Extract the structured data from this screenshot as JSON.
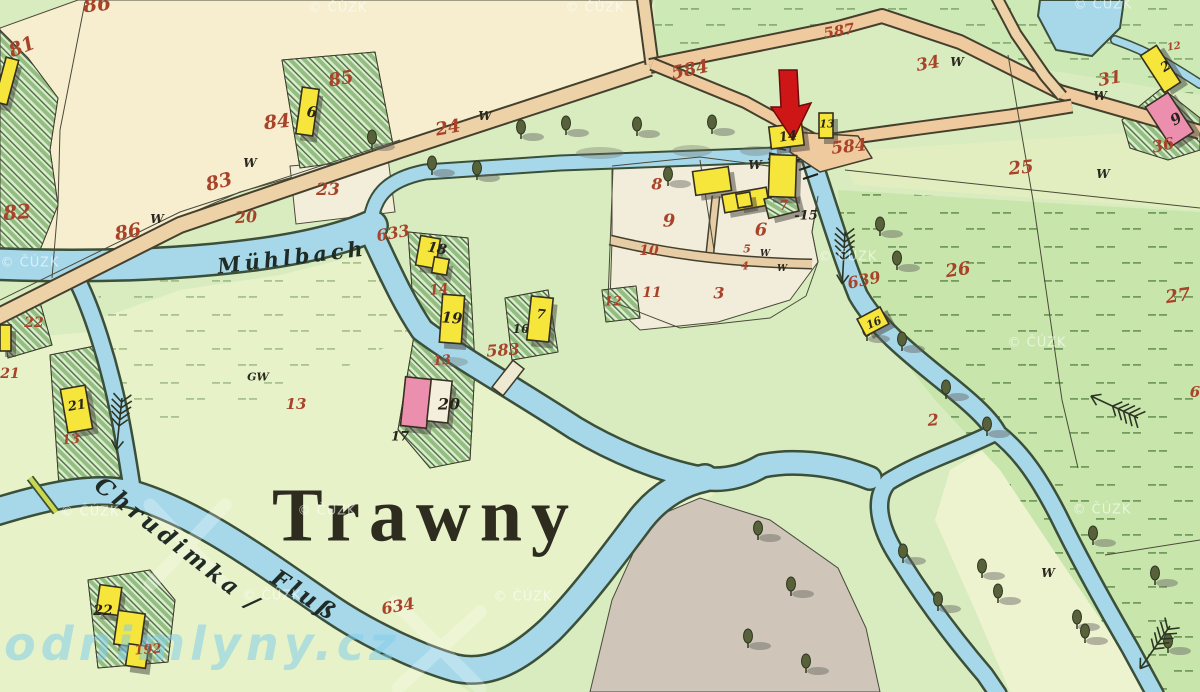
{
  "map": {
    "settlement": {
      "text": "Trawny",
      "x": 425,
      "y": 516,
      "size": 76
    },
    "water_labels": [
      {
        "text": "Mühlbach",
        "x": 292,
        "y": 257,
        "size": 21,
        "rot": -7
      },
      {
        "text": "Chrudimka /",
        "x": 178,
        "y": 545,
        "size": 23,
        "rot": 38
      },
      {
        "text": "Fluß",
        "x": 305,
        "y": 596,
        "size": 23,
        "rot": 33
      }
    ],
    "brand_watermark": {
      "text": "vodnimlyny.cz",
      "x": 185,
      "y": 644,
      "size": 46
    },
    "copyright_watermark_text": "© ČÚZK",
    "watermark_positions": [
      [
        338,
        8
      ],
      [
        595,
        8
      ],
      [
        1103,
        5
      ],
      [
        30,
        263
      ],
      [
        848,
        257
      ],
      [
        1037,
        343
      ],
      [
        1102,
        510
      ],
      [
        90,
        512
      ],
      [
        272,
        596
      ],
      [
        523,
        597
      ],
      [
        327,
        511
      ]
    ],
    "parcel_numbers_red": [
      [
        "86",
        97,
        4,
        20,
        -6
      ],
      [
        "81",
        22,
        47,
        19,
        -22
      ],
      [
        "82",
        17,
        212,
        20,
        -5
      ],
      [
        "86",
        128,
        232,
        19,
        -10
      ],
      [
        "83",
        219,
        182,
        19,
        -14
      ],
      [
        "84",
        277,
        122,
        19,
        -6
      ],
      [
        "85",
        341,
        79,
        18,
        -10
      ],
      [
        "24",
        448,
        128,
        18,
        -10
      ],
      [
        "23",
        328,
        190,
        17,
        0
      ],
      [
        "20",
        246,
        217,
        16,
        -4
      ],
      [
        "633",
        393,
        233,
        16,
        -10
      ],
      [
        "584",
        690,
        70,
        18,
        -12
      ],
      [
        "587",
        839,
        31,
        15,
        -10
      ],
      [
        "584",
        849,
        147,
        17,
        -6
      ],
      [
        "34",
        928,
        64,
        17,
        -10
      ],
      [
        "31",
        1110,
        79,
        17,
        -10
      ],
      [
        "25",
        1021,
        168,
        18,
        -6
      ],
      [
        "12",
        1174,
        47,
        10,
        -10
      ],
      [
        "36",
        1163,
        145,
        16,
        -12
      ],
      [
        "26",
        958,
        270,
        18,
        -8
      ],
      [
        "27",
        1178,
        296,
        18,
        -8
      ],
      [
        "2",
        933,
        420,
        16,
        -4
      ],
      [
        "639",
        864,
        280,
        16,
        -12
      ],
      [
        "8",
        657,
        184,
        16,
        0
      ],
      [
        "9",
        669,
        221,
        18,
        0
      ],
      [
        "6",
        761,
        230,
        18,
        0
      ],
      [
        "10",
        649,
        251,
        14,
        0
      ],
      [
        "5",
        747,
        249,
        11,
        0
      ],
      [
        "4",
        745,
        266,
        11,
        0
      ],
      [
        "11",
        652,
        293,
        14,
        0
      ],
      [
        "3",
        719,
        293,
        16,
        0
      ],
      [
        "12",
        613,
        302,
        13,
        0
      ],
      [
        "7",
        784,
        206,
        13,
        -5
      ],
      [
        "583",
        503,
        350,
        16,
        -4
      ],
      [
        "13",
        296,
        404,
        15,
        0
      ],
      [
        "14",
        439,
        290,
        14,
        -6
      ],
      [
        "13",
        442,
        361,
        13,
        -6
      ],
      [
        "22",
        34,
        323,
        14,
        0
      ],
      [
        "21",
        10,
        374,
        14,
        0
      ],
      [
        "13",
        71,
        440,
        13,
        -6
      ],
      [
        "634",
        398,
        606,
        16,
        -10
      ],
      [
        "192",
        148,
        650,
        13,
        -4
      ],
      [
        "6",
        1195,
        392,
        15,
        0
      ]
    ],
    "house_numbers_black": [
      [
        "6",
        312,
        112,
        15,
        8
      ],
      [
        "14",
        788,
        137,
        13,
        -8
      ],
      [
        "13",
        827,
        124,
        11,
        0
      ],
      [
        "18",
        437,
        249,
        14,
        10
      ],
      [
        "19",
        452,
        318,
        15,
        4
      ],
      [
        "16",
        521,
        329,
        12,
        0
      ],
      [
        "7",
        541,
        315,
        13,
        6
      ],
      [
        "-15",
        806,
        216,
        13,
        0
      ],
      [
        "20",
        449,
        404,
        16,
        0
      ],
      [
        "17",
        400,
        437,
        13,
        0
      ],
      [
        "21",
        77,
        406,
        13,
        -10
      ],
      [
        "22",
        103,
        611,
        14,
        0
      ],
      [
        "2",
        1166,
        67,
        13,
        -33
      ],
      [
        "9",
        1176,
        119,
        15,
        -33
      ],
      [
        "16",
        874,
        323,
        11,
        -24
      ]
    ],
    "w_marks": [
      [
        "W",
        250,
        163,
        12
      ],
      [
        "W",
        157,
        219,
        12
      ],
      [
        "W",
        485,
        116,
        12
      ],
      [
        "W",
        755,
        165,
        12
      ],
      [
        "W",
        765,
        254,
        9
      ],
      [
        "W",
        782,
        269,
        9
      ],
      [
        "W",
        957,
        62,
        12
      ],
      [
        "W",
        1100,
        96,
        12
      ],
      [
        "W",
        1103,
        174,
        12
      ],
      [
        "W",
        1048,
        573,
        12
      ],
      [
        "GW",
        258,
        377,
        11
      ]
    ],
    "annotation_arrow": {
      "color": "#cf1616",
      "x": 790,
      "y": 105,
      "points_to": "mill building 14"
    },
    "buildings": [
      [
        299,
        88,
        17,
        47,
        8,
        "y"
      ],
      [
        0,
        58,
        13,
        46,
        15,
        "y"
      ],
      [
        0,
        325,
        11,
        26,
        0,
        "y"
      ],
      [
        64,
        387,
        25,
        44,
        -10,
        "y"
      ],
      [
        418,
        237,
        20,
        30,
        10,
        "y"
      ],
      [
        433,
        258,
        15,
        16,
        10,
        "y"
      ],
      [
        441,
        295,
        22,
        48,
        4,
        "y"
      ],
      [
        529,
        297,
        22,
        44,
        6,
        "y"
      ],
      [
        403,
        378,
        26,
        49,
        6,
        "p"
      ],
      [
        429,
        380,
        21,
        42,
        6,
        "w"
      ],
      [
        694,
        169,
        36,
        24,
        -8,
        "y"
      ],
      [
        723,
        191,
        45,
        18,
        -10,
        "y"
      ],
      [
        737,
        193,
        14,
        14,
        -10,
        "y"
      ],
      [
        766,
        195,
        31,
        20,
        -14,
        "h"
      ],
      [
        770,
        125,
        33,
        22,
        -7,
        "y"
      ],
      [
        819,
        113,
        14,
        25,
        0,
        "y"
      ],
      [
        769,
        155,
        27,
        42,
        2,
        "y"
      ],
      [
        860,
        312,
        26,
        19,
        -28,
        "y"
      ],
      [
        1151,
        47,
        19,
        44,
        -33,
        "y"
      ],
      [
        1156,
        96,
        27,
        47,
        -33,
        "p"
      ],
      [
        98,
        586,
        22,
        28,
        8,
        "y"
      ],
      [
        116,
        612,
        27,
        34,
        8,
        "y"
      ],
      [
        127,
        645,
        20,
        22,
        8,
        "y"
      ]
    ],
    "trees": [
      [
        372,
        140
      ],
      [
        432,
        166
      ],
      [
        477,
        171
      ],
      [
        521,
        130
      ],
      [
        566,
        126
      ],
      [
        637,
        127
      ],
      [
        712,
        125
      ],
      [
        668,
        177
      ],
      [
        880,
        227
      ],
      [
        897,
        261
      ],
      [
        867,
        332
      ],
      [
        902,
        342
      ],
      [
        946,
        390
      ],
      [
        987,
        427
      ],
      [
        903,
        554
      ],
      [
        982,
        569
      ],
      [
        998,
        594
      ],
      [
        938,
        602
      ],
      [
        1077,
        620
      ],
      [
        1085,
        634
      ],
      [
        1155,
        576
      ],
      [
        1168,
        644
      ],
      [
        758,
        531
      ],
      [
        791,
        587
      ],
      [
        748,
        639
      ],
      [
        806,
        664
      ],
      [
        1093,
        536
      ]
    ],
    "colors": {
      "meadow_green": "#c8e6ab",
      "pale_green": "#e7f2c8",
      "field_cream": "#f6eecf",
      "water_blue": "#a6d8ea",
      "road_tan": "#edd2a8",
      "building_yellow": "#f6e53a",
      "building_pink": "#ec8fae",
      "label_red": "#a8432a",
      "arrow_red": "#cf1616",
      "gray_area": "#cfc6b9"
    }
  }
}
